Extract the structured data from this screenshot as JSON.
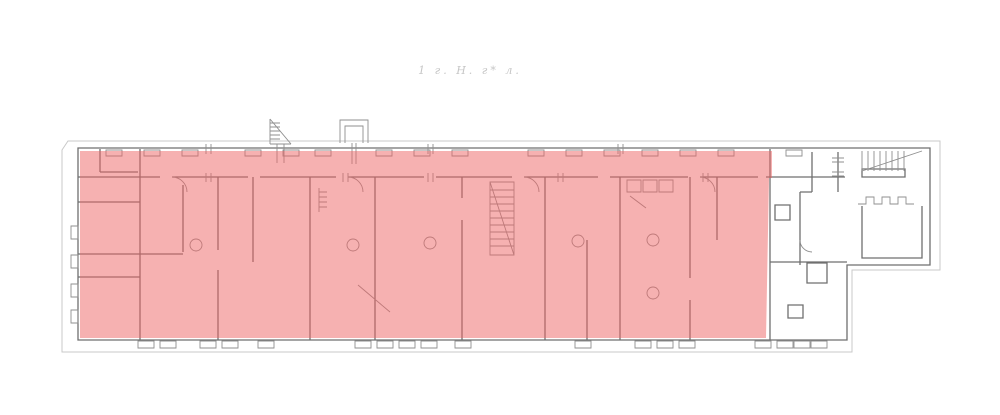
{
  "annotation": {
    "text": "1 г. Н. г* л.",
    "color": "#c6c6c6"
  },
  "plan": {
    "highlight": {
      "fill": "#ee646480"
    },
    "colors": {
      "wall": "#6f6f6f",
      "detail": "#8f8f8f",
      "outline": "#c9c9c9",
      "background": "#ffffff"
    }
  }
}
